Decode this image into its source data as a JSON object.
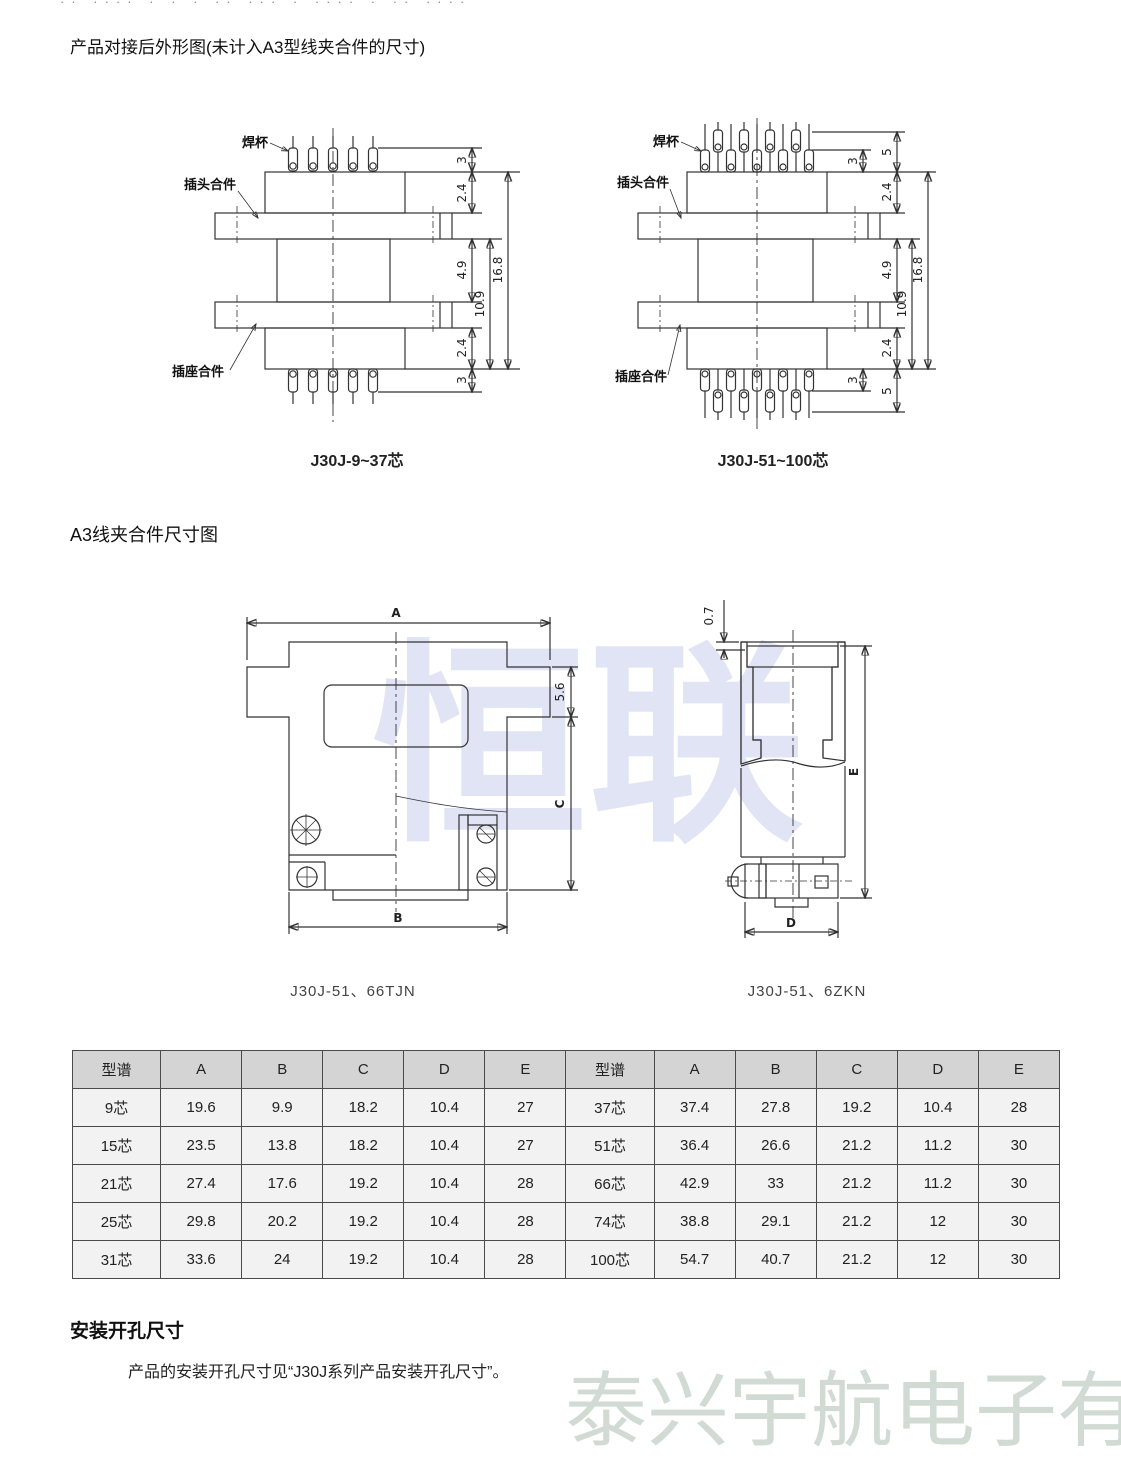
{
  "page": {
    "top_clipped_text": "·· ···· ·  ·  · ·· ··· ·   ····   · ··  ····",
    "watermark_center": "恒联",
    "watermark_bottom": "泰兴宇航电子有限公司"
  },
  "sections": {
    "outline_title": "产品对接后外形图(未计入A3型线夹合件的尺寸)",
    "clamp_title": "A3线夹合件尺寸图",
    "mounting_title": "安装开孔尺寸",
    "mounting_body": "产品的安装开孔尺寸见“J30J系列产品安装开孔尺寸”。"
  },
  "drawing_small": {
    "caption": "J30J-9~37芯",
    "label_solder_cup": "焊杯",
    "label_plug": "插头合件",
    "label_socket": "插座合件",
    "dim_pin_top": "3",
    "dim_shell_top": "2.4",
    "dim_gap": "4.9",
    "dim_inner": "10.9",
    "dim_total": "16.8",
    "dim_shell_bottom": "2.4",
    "dim_pin_bottom": "3"
  },
  "drawing_large": {
    "caption": "J30J-51~100芯",
    "label_solder_cup": "焊杯",
    "label_plug": "插头合件",
    "label_socket": "插座合件",
    "dim_pin_inner_top": "3",
    "dim_pin_outer_top": "5",
    "dim_shell_top": "2.4",
    "dim_gap": "4.9",
    "dim_inner": "10.9",
    "dim_total": "16.8",
    "dim_shell_bottom": "2.4",
    "dim_pin_inner_bottom": "3",
    "dim_pin_outer_bottom": "5"
  },
  "clamp_front": {
    "caption": "J30J-51、66TJN",
    "dim_a": "A",
    "dim_b": "B",
    "dim_c": "C",
    "dim_step": "5.6"
  },
  "clamp_side": {
    "caption": "J30J-51、6ZKN",
    "dim_lip": "0.7",
    "dim_d": "D",
    "dim_e": "E"
  },
  "table": {
    "headers": [
      "型谱",
      "A",
      "B",
      "C",
      "D",
      "E",
      "型谱",
      "A",
      "B",
      "C",
      "D",
      "E"
    ],
    "rows": [
      [
        "9芯",
        "19.6",
        "9.9",
        "18.2",
        "10.4",
        "27",
        "37芯",
        "37.4",
        "27.8",
        "19.2",
        "10.4",
        "28"
      ],
      [
        "15芯",
        "23.5",
        "13.8",
        "18.2",
        "10.4",
        "27",
        "51芯",
        "36.4",
        "26.6",
        "21.2",
        "11.2",
        "30"
      ],
      [
        "21芯",
        "27.4",
        "17.6",
        "19.2",
        "10.4",
        "28",
        "66芯",
        "42.9",
        "33",
        "21.2",
        "11.2",
        "30"
      ],
      [
        "25芯",
        "29.8",
        "20.2",
        "19.2",
        "10.4",
        "28",
        "74芯",
        "38.8",
        "29.1",
        "21.2",
        "12",
        "30"
      ],
      [
        "31芯",
        "33.6",
        "24",
        "19.2",
        "10.4",
        "28",
        "100芯",
        "54.7",
        "40.7",
        "21.2",
        "12",
        "30"
      ]
    ]
  }
}
